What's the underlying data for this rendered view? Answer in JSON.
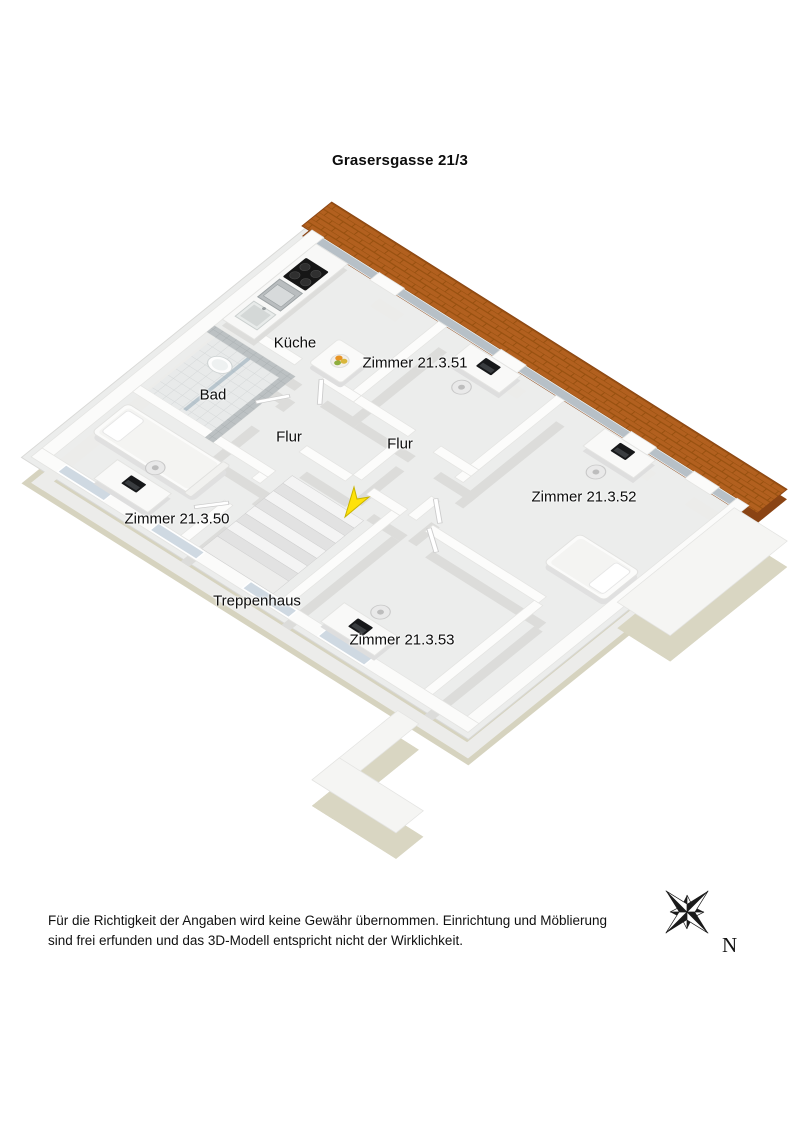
{
  "title": "Grasersgasse 21/3",
  "rooms": {
    "kueche": {
      "label": "Küche"
    },
    "zimmer_51": {
      "label": "Zimmer 21.3.51"
    },
    "bad": {
      "label": "Bad"
    },
    "flur_1": {
      "label": "Flur"
    },
    "flur_2": {
      "label": "Flur"
    },
    "zimmer_52": {
      "label": "Zimmer 21.3.52"
    },
    "zimmer_50": {
      "label": "Zimmer 21.3.50"
    },
    "treppenhaus": {
      "label": "Treppenhaus"
    },
    "zimmer_53": {
      "label": "Zimmer 21.3.53"
    }
  },
  "compass": {
    "north_label": "N"
  },
  "disclaimer": {
    "line1": "Für die Richtigkeit der Angaben wird keine Gewähr übernommen. Einrichtung und Möblierung",
    "line2": "sind frei erfunden und das 3D-Modell entspricht nicht der Wirklichkeit."
  },
  "colors": {
    "roof_tiles": "#b2601f",
    "roof_tiles_dark": "#8a4414",
    "exterior_base": "#d6d3bf",
    "wall_top": "#fbfbfa",
    "floor": "#ecedec",
    "window_glass": "#cfd9e2",
    "glazing_band": "#b7c0c7",
    "marker_yellow": "#ffe20a",
    "compass_black": "#1a1a1a"
  },
  "icons": {
    "compass": "compass-rose-icon",
    "marker": "position-arrow-icon"
  }
}
